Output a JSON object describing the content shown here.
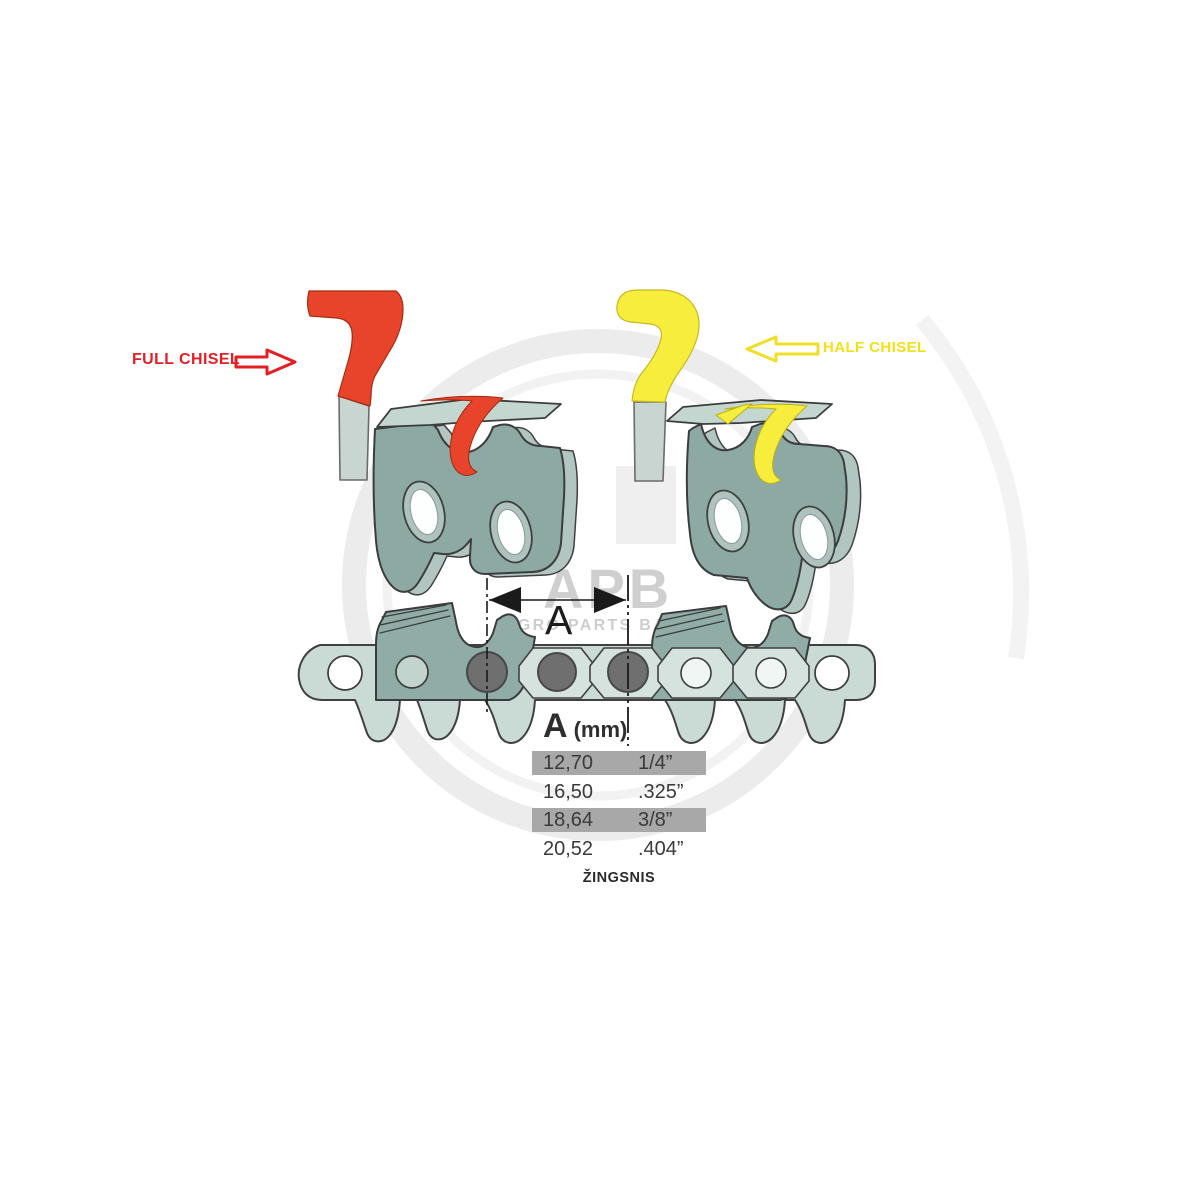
{
  "labels": {
    "full_chisel": "FULL CHISEL",
    "half_chisel": "HALF CHISEL",
    "dimension_letter": "A",
    "pitch_caption": "ŽINGSNIS"
  },
  "table": {
    "header_letter": "A",
    "header_unit": "(mm)",
    "rows": [
      {
        "mm": "12,70",
        "inch": "1/4”",
        "highlighted": true
      },
      {
        "mm": "16,50",
        "inch": ".325”",
        "highlighted": false
      },
      {
        "mm": "18,64",
        "inch": "3/8”",
        "highlighted": true
      },
      {
        "mm": "20,52",
        "inch": ".404”",
        "highlighted": false
      }
    ]
  },
  "watermark": {
    "logo": "APB",
    "subtitle": "AGRO PARTS BALTIJA"
  },
  "icons": {
    "full_chisel_arrow": "arrow-right-outline",
    "half_chisel_arrow": "arrow-left-outline",
    "dimension_arrows": "double-headed-measure-arrow"
  },
  "colors": {
    "full_chisel_red": "#E8442B",
    "half_chisel_yellow": "#F6ED3C",
    "label_red": "#E31E24",
    "label_yellow": "#F2E118",
    "chain_light_teal": "#CADBD5",
    "chain_dark_teal": "#8CA9A4",
    "rivet_gray": "#6F6F6F",
    "row_highlight_gray": "#A8A8A8",
    "table_text": "#3A3A3A",
    "watermark_gray": "#ABABAB",
    "background": "#FFFFFF"
  }
}
